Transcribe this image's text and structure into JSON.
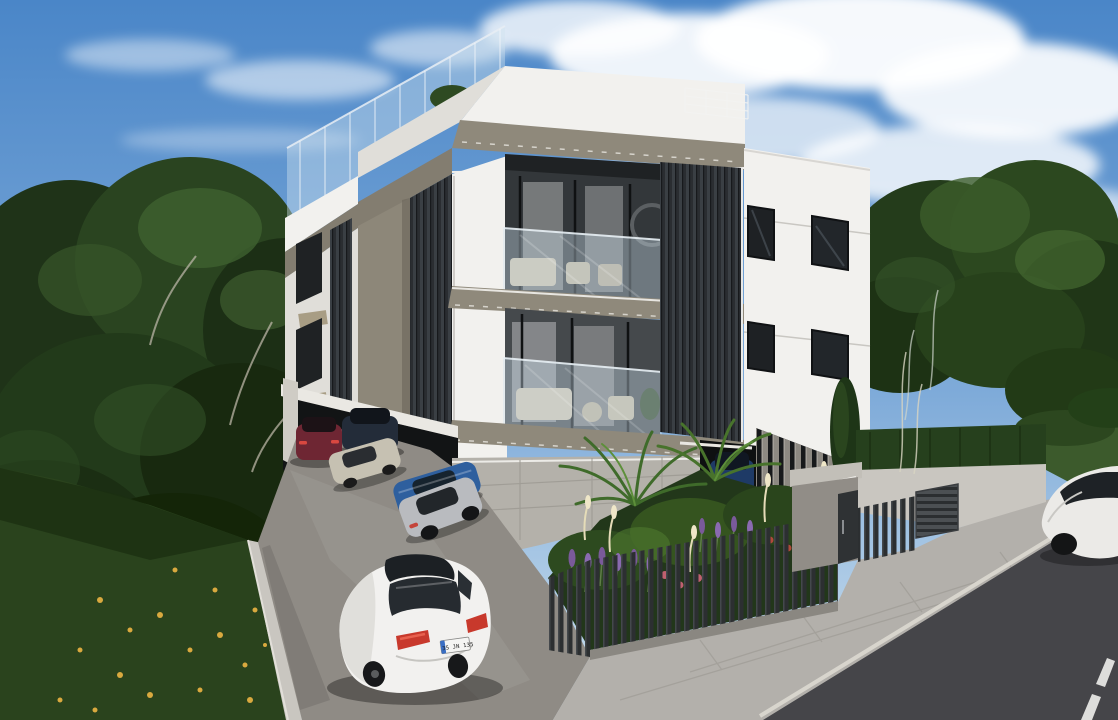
{
  "scene": {
    "description": "Photorealistic 3D exterior rendering of a modern white three-storey apartment building with dark vertical slat cladding, two stacked glass-fronted balconies, a rooftop terrace with glass railing, ground-level parking with several cars, a landscaped garden with palms and lavender behind a charcoal slat fence, concrete sidewalk and an asphalt road with a yellow curb line in the foreground, surrounded by dense green trees under a partly cloudy blue sky.",
    "time_of_day": "day",
    "weather": "partly cloudy"
  },
  "palette": {
    "sky_top": "#4a86c8",
    "sky_mid": "#7fabd9",
    "sky_horizon": "#cfe2ef",
    "cloud_white": "#ffffff",
    "foliage_dark": "#203618",
    "foliage_mid": "#2e4a20",
    "foliage_light": "#49692f",
    "grass_green": "#2a431d",
    "hedge_green": "#26401d",
    "grass_strip": "#3c5a2c",
    "autumn_leaf": "#d9a93f",
    "facade_white": "#f2f1ee",
    "facade_shaded": "#e0ded9",
    "fascia_taupe": "#8f897b",
    "fascia_taupe_shaded": "#837d70",
    "slat_charcoal": "#2a2d31",
    "glass_blue": "#cfe2ee",
    "interior_dark": "#33373a",
    "concrete_base": "#b4b1aa",
    "concrete_fin": "#8d8982",
    "parking_asphalt": "#8f8b85",
    "sidewalk_paver": "#b3b0ab",
    "road_asphalt": "#454549",
    "curb_yellow": "#eae2a2",
    "lane_dash": "#dddddb",
    "fence_charcoal": "#2c2f31",
    "retaining_wall": "#c9c6c0",
    "entrance_concrete": "#918d87"
  },
  "building": {
    "storeys": 3,
    "balconies": 2,
    "features": [
      "rooftop terrace with frameless glass railing",
      "white rendered facade",
      "taupe fascia bands with drip lines",
      "dark charcoal vertical slat cladding",
      "stacked balconies with glass balustrades and curtained sliding doors",
      "stone-clad basement wall",
      "covered ground-level parking",
      "white wire roof railing",
      "cypress tree at side wall"
    ]
  },
  "vehicles": {
    "parked": [
      {
        "name": "maroon-sedan",
        "color": "#6e2633"
      },
      {
        "name": "navy-sedan",
        "color": "#232c39"
      },
      {
        "name": "beige-sedan",
        "color": "#c6c1b2"
      },
      {
        "name": "blue-sedan",
        "color": "#2e5f9e"
      },
      {
        "name": "silver-sedan",
        "color": "#b9bbbf"
      },
      {
        "name": "dark-blue-sedan",
        "color": "#1e3a66"
      }
    ],
    "white_sedan": {
      "color": "#f2f1ef",
      "plate_text": "35 JN 135",
      "plate_band_color": "#3a6fc4",
      "taillight_color": "#c8392c"
    },
    "street_car": {
      "color": "#ebeae7"
    }
  },
  "road": {
    "surface_color": "#454549",
    "curb_line_color": "#eae2a2",
    "curb_line_style": "solid yellow along curb",
    "lane_marking_color": "#dddddb",
    "lane_marking_style": "white dashed center line"
  },
  "garden": {
    "plants": [
      "palm",
      "lavender",
      "ornamental grass plumes",
      "pink flowers",
      "cypress",
      "hedge"
    ],
    "fence": "vertical charcoal slat fence on concrete curb"
  }
}
